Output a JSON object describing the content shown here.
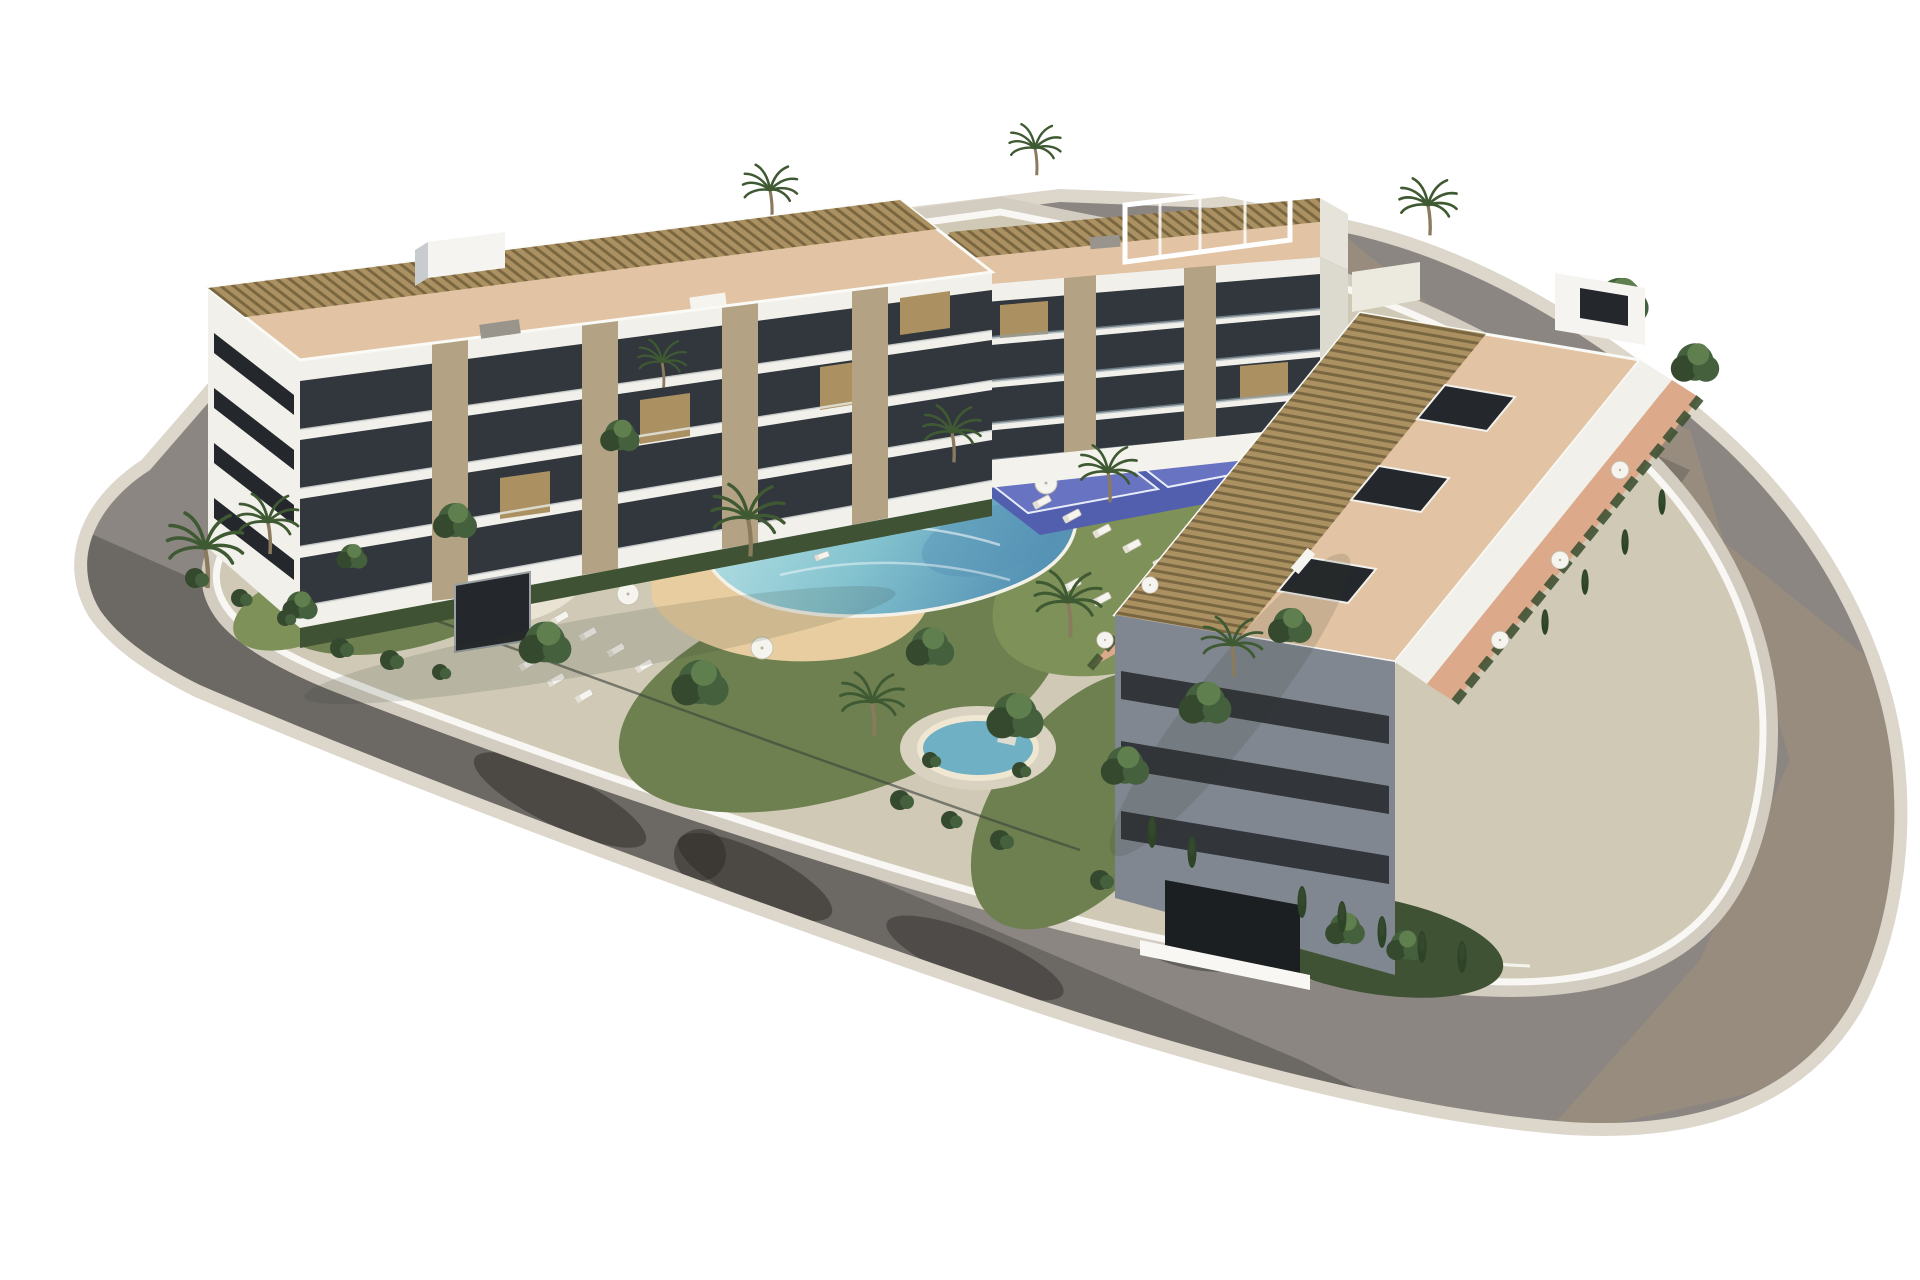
{
  "meta": {
    "description": "Aerial 3D architectural rendering of a modern white apartment complex on a rounded corner plot, surrounded by an asphalt ring road, with a central landscaped garden containing a lagoon-style beach-entry pool, a round spa pool, a small kidney pool, a kids splash pool, blue padel courts, sun loungers, parasols, palm trees and cypresses. Three low-rise blocks with glass balconies, stone piers, roof terraces with timber pergolas and terracotta floors.",
    "text_content": "none"
  },
  "scene": {
    "background": "#ffffff",
    "objects": {
      "buildings": [
        {
          "id": "left-building",
          "label": "left apartment block",
          "storeys_visible": 4
        },
        {
          "id": "center-building",
          "label": "back apartment block",
          "storeys_visible": 4
        },
        {
          "id": "right-building",
          "label": "right apartment block",
          "storeys_visible": 4
        }
      ],
      "amenities": [
        "ring-road",
        "sidewalk",
        "perimeter-wall",
        "lagoon-pool",
        "beach-entry",
        "spa-pool",
        "kidney-pool",
        "kids-splash-pool",
        "padel-courts",
        "sun-loungers",
        "parasols",
        "lawns",
        "palm-trees",
        "cypress-trees",
        "garden-shrubs",
        "rooftop-pergolas",
        "roof-terraces",
        "skylights",
        "garage-doors"
      ]
    },
    "colors": {
      "road": "#8b8682",
      "road_warm": "#b49a78",
      "road_shadow": "#2b2926",
      "sidewalk": "#d3ccc0",
      "curb": "#dcd6cb",
      "wall": "#f8f7f4",
      "plot": "#cfc9b6",
      "grass": "#6e8050",
      "grass_light": "#7e9159",
      "hedge": "#3f5233",
      "sand": "#e7cda0",
      "deck": "#e9e3d4",
      "pool_light": "#c2e7e9",
      "pool_mid": "#84c3cf",
      "pool_deep": "#5693b5",
      "pool_rim": "#f4f1e8",
      "pool_edge_dark": "#3f7291",
      "spa": "#6fb0c4",
      "kidney": "#a6d6de",
      "kids_pool": "#9fd0dc",
      "court": "#515fae",
      "court_light": "#6874c2",
      "court_fence": "#33415f",
      "wood": "#ab9161",
      "wood_dark": "#7a6742",
      "terra_roof": "#e2c3a3",
      "terra_floor": "#dca98a",
      "facade": "#f2f0ea",
      "facade_dim": "#e8e5dc",
      "facade_shadow": "#808790",
      "window": "#24272b",
      "recess": "#31373d",
      "stone": "#b3a284",
      "glass_rail": "#8fa0ab",
      "tree": "#44603c",
      "tree_dark": "#35492e",
      "tree_light": "#5f7f4e",
      "palm": "#3f5a33",
      "trunk": "#8a7a5e",
      "cypress": "#2e4429",
      "furniture_white": "#f6f4ee",
      "furniture_gray": "#9a958c",
      "stone_wall": "#ab9a76",
      "stone_wall_top": "#d6c9a6"
    }
  }
}
